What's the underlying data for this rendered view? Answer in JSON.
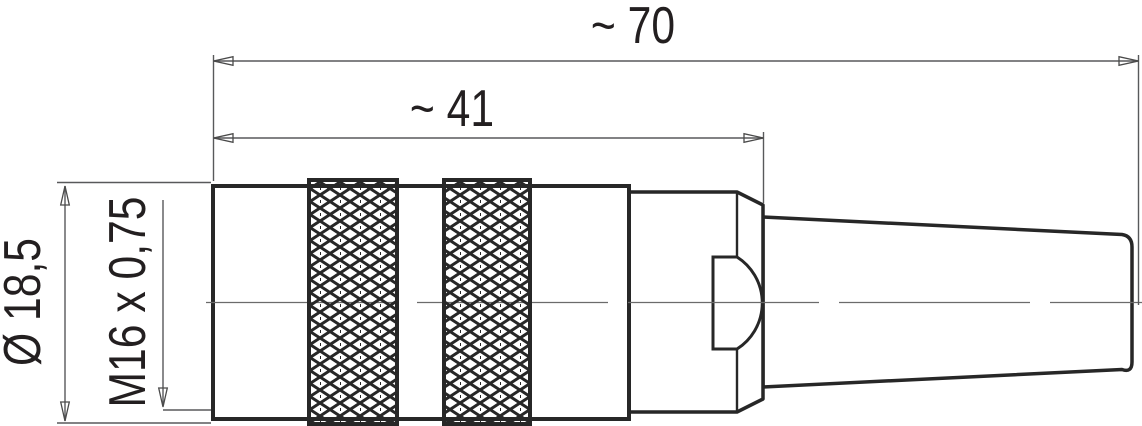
{
  "drawing": {
    "kind": "technical-drawing",
    "subject": "M16 circular cable connector, side view with knurled coupling rings and cable strain relief",
    "labels": {
      "overall_length": "~ 70",
      "body_length": "~ 41",
      "diameter": "Ø 18,5",
      "thread_spec": "M16 x 0,75"
    },
    "colors": {
      "outline": "#272727",
      "dim_line": "#58595b",
      "arrow": "#4a4a4a",
      "centerline": "#6b6b6b",
      "text": "#231f20",
      "background": "#ffffff"
    }
  }
}
